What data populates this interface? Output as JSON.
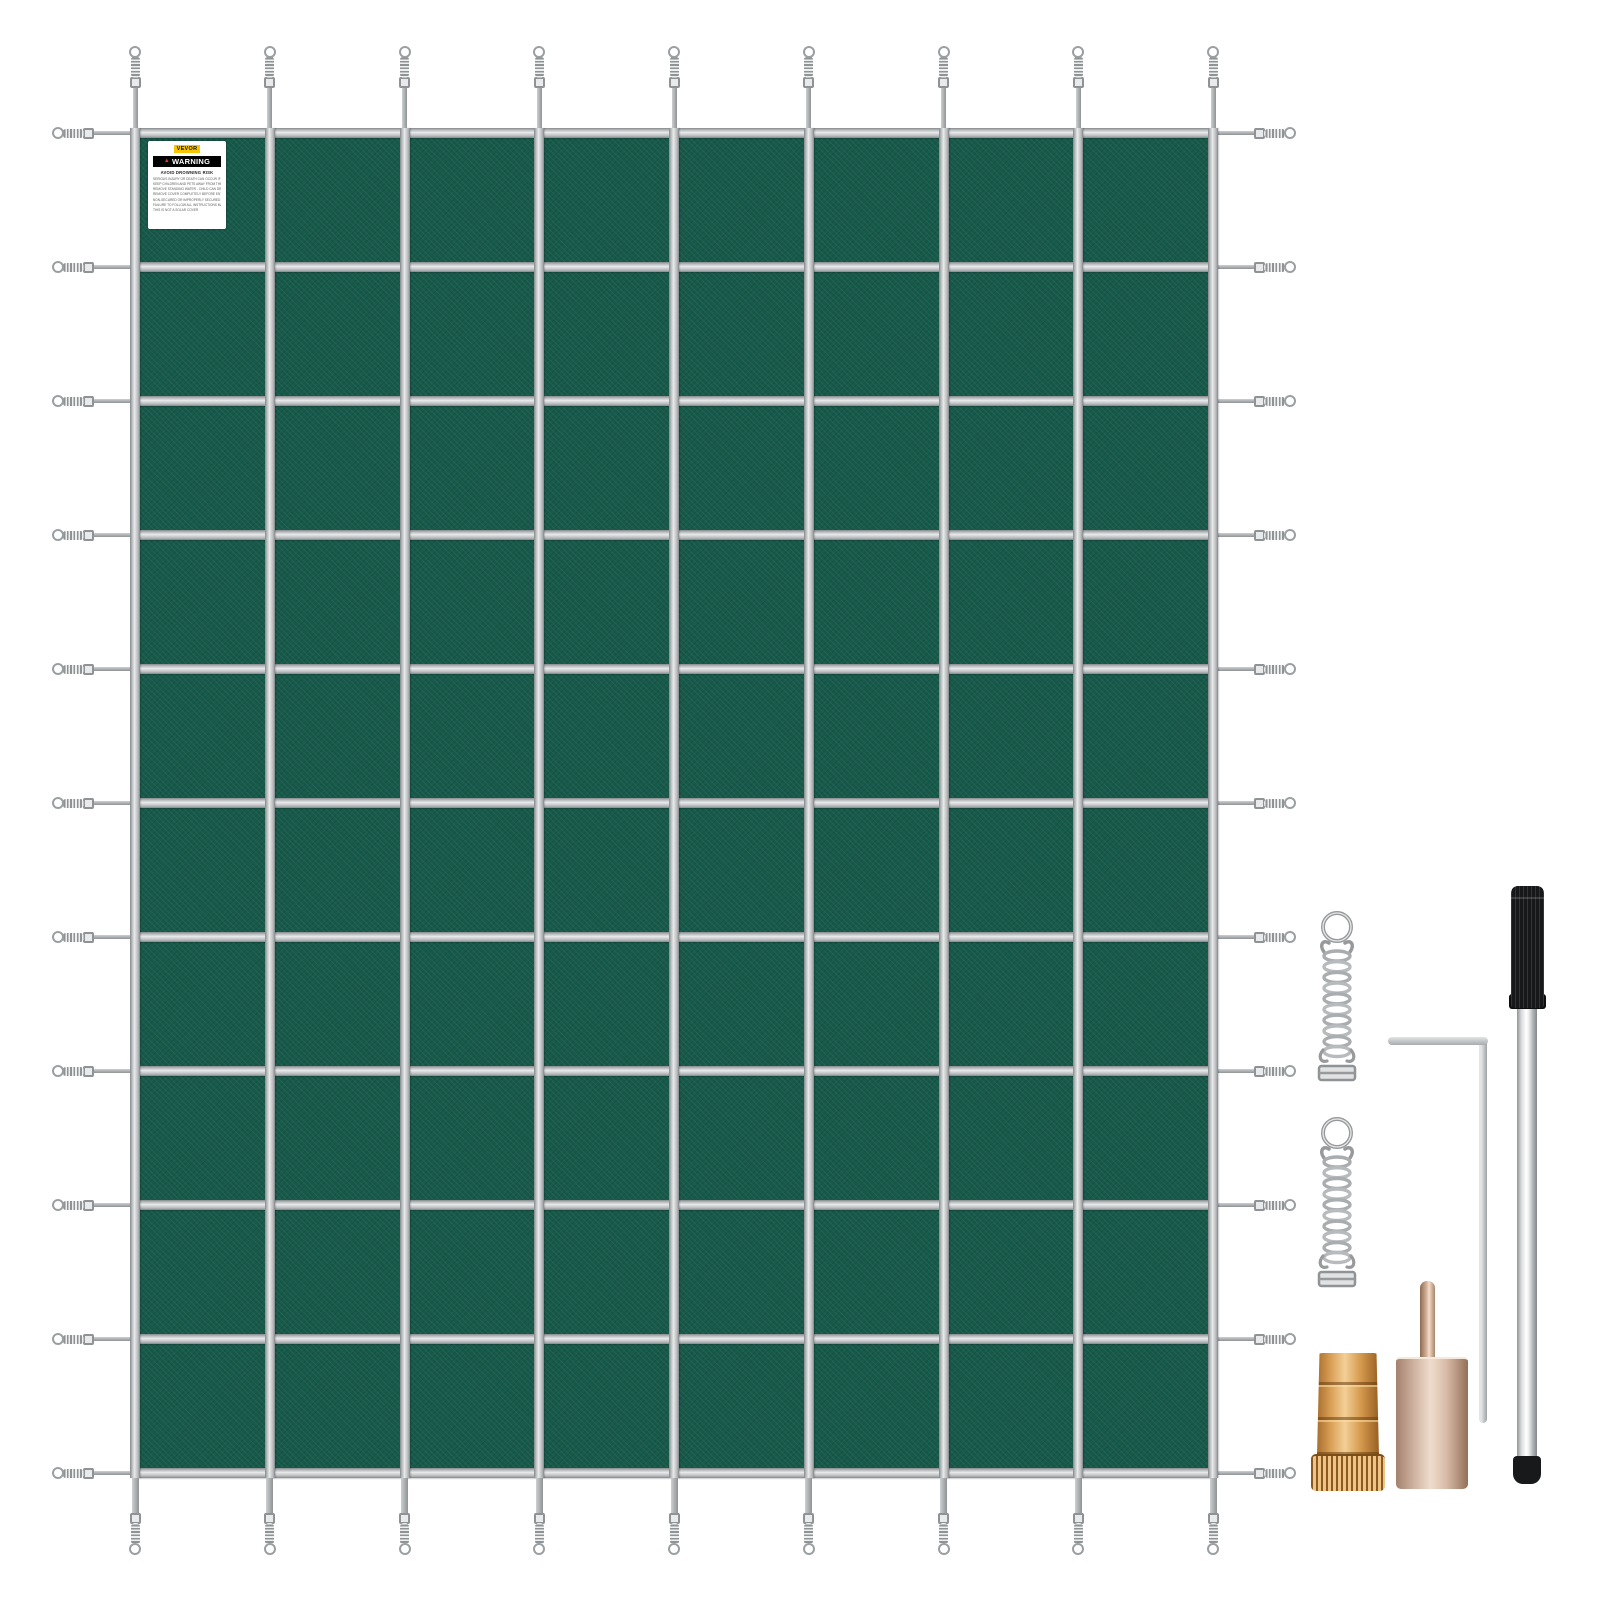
{
  "product": {
    "name": "Pool Safety Cover",
    "fabric_color": "#17594a",
    "strap_silver": "#b7babc",
    "strap_highlight": "#eaeced",
    "strap_shadow": "#84888a",
    "spring_metal": "#a9adaf",
    "brass_color": "#d99f55",
    "copper_tool_color": "#d8bba8",
    "rod_handle_color": "#17181a"
  },
  "label": {
    "brand": "VEVOR",
    "brand_badge_color": "#f7c600",
    "warning_title": "WARNING",
    "warning_accent": "#e8322e",
    "warning_subtitle": "AVOID  DROWNING RISK",
    "warning_lines": [
      "SERIOUS INJURY OR DEATH CAN OCCUR IF ANYONE IS ON THE COVER",
      "KEEP CHILDREN AND PETS AWAY FROM THE COVER",
      "REMOVE STANDING WATER - CHILD CAN DROWN ON TOP OF COVER",
      "REMOVE COVER COMPLETELY BEFORE ENTRY OF BATHERS",
      "NON-SECURED OR IMPROPERLY SECURED COVERS ARE A HAZARD",
      "FAILURE TO FOLLOW ALL INSTRUCTIONS MAY RESULT IN INJURY",
      "THIS IS NOT A SOLAR COVER"
    ]
  },
  "cover": {
    "x": 135,
    "y": 133,
    "width": 1078,
    "height": 1340,
    "rows": 10,
    "columns": 8,
    "strap_width": 10,
    "vertical_strap_x": [
      135,
      269.8,
      404.5,
      539.3,
      674,
      808.8,
      943.5,
      1078.3,
      1213
    ],
    "horizontal_strap_y": [
      133,
      267,
      401,
      535,
      669,
      803,
      937,
      1071,
      1205,
      1339,
      1473
    ],
    "tail": {
      "side_line_len": 41,
      "side_line_thick": 4,
      "top_line_len": 41,
      "top_line_thick": 5,
      "bottom_line_len": 36,
      "bottom_line_thick": 7,
      "coil_len": 22,
      "coil_thick": 9,
      "buckle_size": 11,
      "ring_size": 12
    }
  },
  "hardware": {
    "items": [
      {
        "name": "anchor-spring-1",
        "kind": "stainless tension spring with buckle"
      },
      {
        "name": "anchor-spring-2",
        "kind": "stainless tension spring with buckle"
      },
      {
        "name": "hex-key",
        "kind": "L-shaped allen key"
      },
      {
        "name": "installation-rod",
        "kind": "anchor installation rod with black grip"
      },
      {
        "name": "brass-anchor",
        "kind": "knurled brass deck anchor"
      },
      {
        "name": "tamping-tool",
        "kind": "anchor tamping tool with center pin"
      }
    ]
  }
}
